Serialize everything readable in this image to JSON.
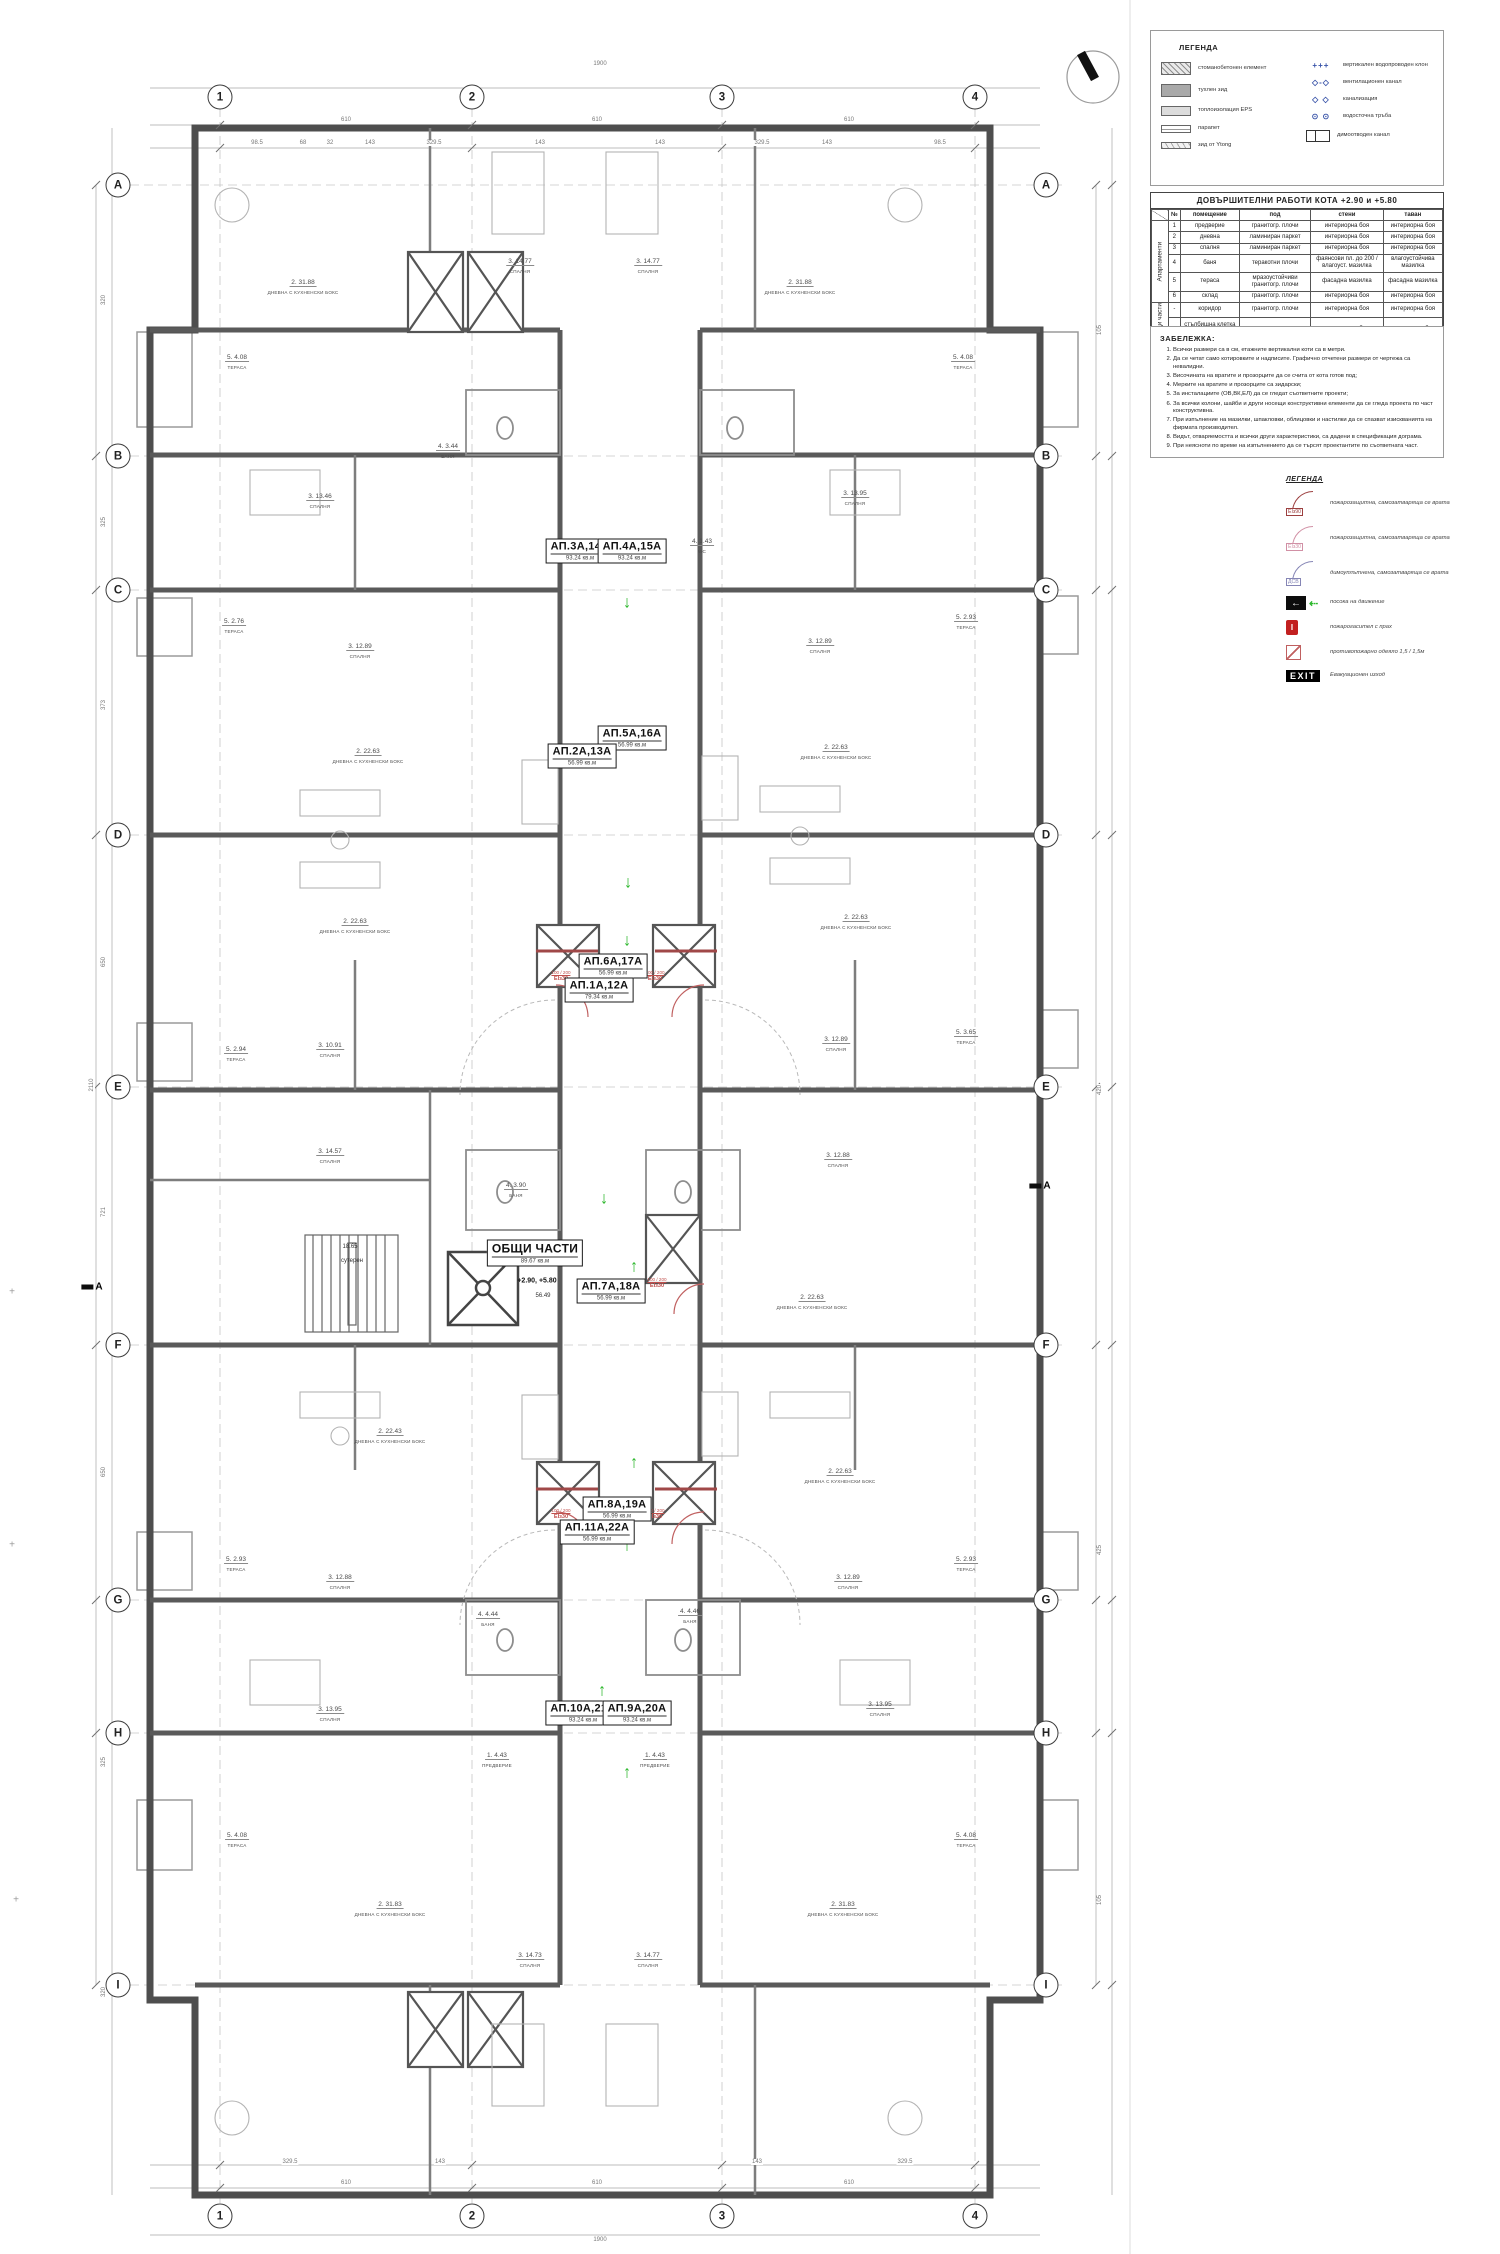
{
  "plan": {
    "grid": {
      "columns": [
        {
          "label": "1",
          "x": 220
        },
        {
          "label": "2",
          "x": 472
        },
        {
          "label": "3",
          "x": 722
        },
        {
          "label": "4",
          "x": 975
        }
      ],
      "top_y": 97,
      "bottom_y": 2216,
      "rows": [
        {
          "label": "A",
          "y": 185
        },
        {
          "label": "B",
          "y": 456
        },
        {
          "label": "C",
          "y": 590
        },
        {
          "label": "D",
          "y": 835
        },
        {
          "label": "E",
          "y": 1087
        },
        {
          "label": "F",
          "y": 1345
        },
        {
          "label": "G",
          "y": 1600
        },
        {
          "label": "H",
          "y": 1733
        },
        {
          "label": "I",
          "y": 1985
        }
      ],
      "left_x": 118,
      "right_x": 1046
    },
    "apartments": [
      {
        "name": "АП.3А,14А",
        "area": "93.24  кв.м",
        "x": 580,
        "y": 551
      },
      {
        "name": "АП.4А,15А",
        "area": "93.24  кв.м",
        "x": 632,
        "y": 551
      },
      {
        "name": "АП.5А,16А",
        "area": "56.99  кв.м",
        "x": 632,
        "y": 738
      },
      {
        "name": "АП.2А,13А",
        "area": "56.99  кв.м",
        "x": 582,
        "y": 756
      },
      {
        "name": "АП.6А,17А",
        "area": "56.99  кв.м",
        "x": 613,
        "y": 966
      },
      {
        "name": "АП.1А,12А",
        "area": "79.34  кв.м",
        "x": 599,
        "y": 990
      },
      {
        "name": "АП.7А,18А",
        "area": "56.99  кв.м",
        "x": 611,
        "y": 1291
      },
      {
        "name": "АП.8А,19А",
        "area": "56.99  кв.м",
        "x": 617,
        "y": 1509
      },
      {
        "name": "АП.11А,22А",
        "area": "56.99  кв.м",
        "x": 597,
        "y": 1532
      },
      {
        "name": "АП.10А,21А",
        "area": "93.24  кв.м",
        "x": 583,
        "y": 1713
      },
      {
        "name": "АП.9А,20А",
        "area": "93.24  кв.м",
        "x": 637,
        "y": 1713
      }
    ],
    "common_area": {
      "name": "ОБЩИ ЧАСТИ",
      "area": "89.67  кв.м",
      "x": 535,
      "y": 1253
    },
    "rooms": [
      {
        "x": 303,
        "y": 283,
        "a": "2. 31.88",
        "n": "ДНЕВНА С КУХНЕНСКИ БОКС"
      },
      {
        "x": 800,
        "y": 283,
        "a": "2. 31.88",
        "n": "ДНЕВНА С КУХНЕНСКИ БОКС"
      },
      {
        "x": 520,
        "y": 262,
        "a": "3. 14.77",
        "n": "СПАЛНЯ"
      },
      {
        "x": 648,
        "y": 262,
        "a": "3. 14.77",
        "n": "СПАЛНЯ"
      },
      {
        "x": 237,
        "y": 358,
        "a": "5. 4.08",
        "n": "ТЕРАСА"
      },
      {
        "x": 963,
        "y": 358,
        "a": "5. 4.08",
        "n": "ТЕРАСА"
      },
      {
        "x": 448,
        "y": 447,
        "a": "4. 3.44",
        "n": "БАНЯ"
      },
      {
        "x": 320,
        "y": 497,
        "a": "3. 13.46",
        "n": "СПАЛНЯ"
      },
      {
        "x": 855,
        "y": 494,
        "a": "3. 13.95",
        "n": "СПАЛНЯ"
      },
      {
        "x": 702,
        "y": 542,
        "a": "4. 1.43",
        "n": "WC"
      },
      {
        "x": 360,
        "y": 647,
        "a": "3. 12.89",
        "n": "СПАЛНЯ"
      },
      {
        "x": 820,
        "y": 642,
        "a": "3. 12.89",
        "n": "СПАЛНЯ"
      },
      {
        "x": 234,
        "y": 622,
        "a": "5. 2.76",
        "n": "ТЕРАСА"
      },
      {
        "x": 966,
        "y": 618,
        "a": "5. 2.93",
        "n": "ТЕРАСА"
      },
      {
        "x": 368,
        "y": 752,
        "a": "2. 22.63",
        "n": "ДНЕВНА С КУХНЕНСКИ БОКС"
      },
      {
        "x": 836,
        "y": 748,
        "a": "2. 22.63",
        "n": "ДНЕВНА С КУХНЕНСКИ БОКС"
      },
      {
        "x": 355,
        "y": 922,
        "a": "2. 22.63",
        "n": "ДНЕВНА С КУХНЕНСКИ БОКС"
      },
      {
        "x": 856,
        "y": 918,
        "a": "2. 22.63",
        "n": "ДНЕВНА С КУХНЕНСКИ БОКС"
      },
      {
        "x": 330,
        "y": 1046,
        "a": "3. 10.91",
        "n": "СПАЛНЯ"
      },
      {
        "x": 836,
        "y": 1040,
        "a": "3. 12.89",
        "n": "СПАЛНЯ"
      },
      {
        "x": 236,
        "y": 1050,
        "a": "5. 2.94",
        "n": "ТЕРАСА"
      },
      {
        "x": 966,
        "y": 1033,
        "a": "5. 3.65",
        "n": "ТЕРАСА"
      },
      {
        "x": 330,
        "y": 1152,
        "a": "3. 14.57",
        "n": "СПАЛНЯ"
      },
      {
        "x": 838,
        "y": 1156,
        "a": "3. 12.88",
        "n": "СПАЛНЯ"
      },
      {
        "x": 516,
        "y": 1186,
        "a": "4. 3.90",
        "n": "БАНЯ"
      },
      {
        "x": 812,
        "y": 1298,
        "a": "2. 22.63",
        "n": "ДНЕВНА С КУХНЕНСКИ БОКС"
      },
      {
        "x": 390,
        "y": 1432,
        "a": "2. 22.43",
        "n": "ДНЕВНА С КУХНЕНСКИ БОКС"
      },
      {
        "x": 840,
        "y": 1472,
        "a": "2. 22.63",
        "n": "ДНЕВНА С КУХНЕНСКИ БОКС"
      },
      {
        "x": 340,
        "y": 1578,
        "a": "3. 12.88",
        "n": "СПАЛНЯ"
      },
      {
        "x": 848,
        "y": 1578,
        "a": "3. 12.89",
        "n": "СПАЛНЯ"
      },
      {
        "x": 236,
        "y": 1560,
        "a": "5. 2.93",
        "n": "ТЕРАСА"
      },
      {
        "x": 966,
        "y": 1560,
        "a": "5. 2.93",
        "n": "ТЕРАСА"
      },
      {
        "x": 488,
        "y": 1615,
        "a": "4. 4.44",
        "n": "БАНЯ"
      },
      {
        "x": 690,
        "y": 1612,
        "a": "4. 4.46",
        "n": "БАНЯ"
      },
      {
        "x": 330,
        "y": 1710,
        "a": "3. 13.95",
        "n": "СПАЛНЯ"
      },
      {
        "x": 880,
        "y": 1705,
        "a": "3. 13.95",
        "n": "СПАЛНЯ"
      },
      {
        "x": 497,
        "y": 1756,
        "a": "1. 4.43",
        "n": "ПРЕДВЕРИЕ"
      },
      {
        "x": 655,
        "y": 1756,
        "a": "1. 4.43",
        "n": "ПРЕДВЕРИЕ"
      },
      {
        "x": 237,
        "y": 1836,
        "a": "5. 4.08",
        "n": "ТЕРАСА"
      },
      {
        "x": 966,
        "y": 1836,
        "a": "5. 4.08",
        "n": "ТЕРАСА"
      },
      {
        "x": 390,
        "y": 1905,
        "a": "2. 31.83",
        "n": "ДНЕВНА С КУХНЕНСКИ БОКС"
      },
      {
        "x": 843,
        "y": 1905,
        "a": "2. 31.83",
        "n": "ДНЕВНА С КУХНЕНСКИ БОКС"
      },
      {
        "x": 530,
        "y": 1956,
        "a": "3. 14.73",
        "n": "СПАЛНЯ"
      },
      {
        "x": 648,
        "y": 1956,
        "a": "3. 14.77",
        "n": "СПАЛНЯ"
      }
    ],
    "extras": [
      {
        "x": 537,
        "y": 1281,
        "t": "+2.90, +5.80",
        "b": true
      },
      {
        "x": 543,
        "y": 1296,
        "t": "56.49"
      },
      {
        "x": 350,
        "y": 1247,
        "t": "18.65"
      },
      {
        "x": 352,
        "y": 1261,
        "t": "сутерен"
      }
    ],
    "door_labels": {
      "dim": "100 / 200",
      "tag": "EIз30",
      "positions": [
        {
          "x": 561,
          "y": 976
        },
        {
          "x": 655,
          "y": 976
        },
        {
          "x": 657,
          "y": 1283
        },
        {
          "x": 561,
          "y": 1514
        },
        {
          "x": 655,
          "y": 1514
        }
      ]
    },
    "arrows": [
      {
        "x": 627,
        "y": 602,
        "d": "down"
      },
      {
        "x": 627,
        "y": 737,
        "d": "down"
      },
      {
        "x": 628,
        "y": 882,
        "d": "down"
      },
      {
        "x": 627,
        "y": 940,
        "d": "down"
      },
      {
        "x": 604,
        "y": 1198,
        "d": "down"
      },
      {
        "x": 573,
        "y": 1257,
        "d": "left"
      },
      {
        "x": 634,
        "y": 1266,
        "d": "up"
      },
      {
        "x": 634,
        "y": 1462,
        "d": "up"
      },
      {
        "x": 627,
        "y": 1545,
        "d": "up"
      },
      {
        "x": 602,
        "y": 1690,
        "d": "up"
      },
      {
        "x": 627,
        "y": 1772,
        "d": "up"
      }
    ],
    "dims": {
      "top": [
        {
          "x": 600,
          "y": 64,
          "t": "1900"
        },
        {
          "x": 346,
          "y": 120,
          "t": "610"
        },
        {
          "x": 597,
          "y": 120,
          "t": "610"
        },
        {
          "x": 849,
          "y": 120,
          "t": "610"
        },
        {
          "x": 257,
          "y": 143,
          "t": "98.5"
        },
        {
          "x": 303,
          "y": 143,
          "t": "68"
        },
        {
          "x": 330,
          "y": 143,
          "t": "32"
        },
        {
          "x": 370,
          "y": 143,
          "t": "143"
        },
        {
          "x": 434,
          "y": 143,
          "t": "329.5"
        },
        {
          "x": 540,
          "y": 143,
          "t": "143"
        },
        {
          "x": 660,
          "y": 143,
          "t": "143"
        },
        {
          "x": 762,
          "y": 143,
          "t": "329.5"
        },
        {
          "x": 827,
          "y": 143,
          "t": "143"
        },
        {
          "x": 940,
          "y": 143,
          "t": "98.5"
        }
      ],
      "bottom": [
        {
          "x": 600,
          "y": 2240,
          "t": "1900"
        },
        {
          "x": 346,
          "y": 2183,
          "t": "610"
        },
        {
          "x": 597,
          "y": 2183,
          "t": "610"
        },
        {
          "x": 849,
          "y": 2183,
          "t": "610"
        },
        {
          "x": 290,
          "y": 2162,
          "t": "329.5"
        },
        {
          "x": 905,
          "y": 2162,
          "t": "329.5"
        },
        {
          "x": 440,
          "y": 2162,
          "t": "143"
        },
        {
          "x": 757,
          "y": 2162,
          "t": "143"
        }
      ],
      "left": [
        {
          "x": 104,
          "y": 300,
          "t": "320"
        },
        {
          "x": 104,
          "y": 522,
          "t": "325"
        },
        {
          "x": 104,
          "y": 705,
          "t": "373"
        },
        {
          "x": 104,
          "y": 962,
          "t": "650"
        },
        {
          "x": 104,
          "y": 1212,
          "t": "721"
        },
        {
          "x": 104,
          "y": 1472,
          "t": "650"
        },
        {
          "x": 104,
          "y": 1762,
          "t": "325"
        },
        {
          "x": 104,
          "y": 1992,
          "t": "320"
        },
        {
          "x": 92,
          "y": 1085,
          "t": "2110"
        }
      ],
      "right": [
        {
          "x": 1100,
          "y": 330,
          "t": "105"
        },
        {
          "x": 1100,
          "y": 1090,
          "t": "420"
        },
        {
          "x": 1100,
          "y": 1550,
          "t": "425"
        },
        {
          "x": 1100,
          "y": 1900,
          "t": "105"
        }
      ]
    },
    "section": {
      "label": "А",
      "markers": [
        {
          "x": 92,
          "y": 1287
        },
        {
          "x": 1040,
          "y": 1186
        }
      ]
    },
    "cross_marks": [
      {
        "x": 12,
        "y": 1292,
        "t": "+"
      },
      {
        "x": 12,
        "y": 1545,
        "t": "+"
      },
      {
        "x": 16,
        "y": 1900,
        "t": "+"
      }
    ]
  },
  "legend1": {
    "title": "ЛЕГЕНДА",
    "left_items": [
      {
        "icon": "concrete-swatch",
        "label": "стоманобетонен елемент"
      },
      {
        "icon": "brick-swatch",
        "label": "тухлен зид"
      },
      {
        "icon": "eps-swatch",
        "label": "топлоизолация EPS"
      },
      {
        "icon": "parapet-swatch",
        "label": "парапет"
      },
      {
        "icon": "ytong-swatch",
        "label": "зид от Ytong"
      }
    ],
    "right_items": [
      {
        "icon": "water-riser",
        "glyph": "+++",
        "label": "вертикален водопроводен клон"
      },
      {
        "icon": "vent-duct",
        "glyph": "◇-◇",
        "label": "вентилационен канал"
      },
      {
        "icon": "sewer",
        "glyph": "◇ ◇",
        "label": "канализация"
      },
      {
        "icon": "downpipe",
        "glyph": "⊙ ⊙",
        "label": "водосточна тръба"
      },
      {
        "icon": "smoke-duct",
        "glyph": "",
        "label": "димоотводен канал"
      }
    ]
  },
  "finish_table": {
    "title": "ДОВЪРШИТЕЛНИ РАБОТИ КОТА +2.90 и +5.80",
    "columns": [
      "№",
      "помещение",
      "под",
      "стени",
      "таван"
    ],
    "groups": [
      {
        "name": "Апартаменти",
        "rows": [
          [
            "1",
            "предверие",
            "гранитогр. плочи",
            "интериорна боя",
            "интериорна боя"
          ],
          [
            "2",
            "дневна",
            "ламиниран паркет",
            "интериорна боя",
            "интериорна боя"
          ],
          [
            "3",
            "спалня",
            "ламиниран паркет",
            "интериорна боя",
            "интериорна боя"
          ],
          [
            "4",
            "баня",
            "теракотни плочи",
            "фаянсови пл. до 200 / влагоуст. мазилка",
            "влагоустойчива мазилка"
          ],
          [
            "5",
            "тераса",
            "мразоустойчиви гранитогр. плочи",
            "фасадна мазилка",
            "фасадна мазилка"
          ],
          [
            "6",
            "склад",
            "гранитогр. плочи",
            "интериорна боя",
            "интериорна боя"
          ]
        ]
      },
      {
        "name": "Общи части",
        "rows": [
          [
            "-",
            "коридор",
            "гранитогр. плочи",
            "интериорна боя",
            "интериорна боя"
          ],
          [
            "-",
            "стълбищна клетка с коридор",
            "гранитогр. плочи",
            "интериорна боя",
            "интериорна боя"
          ]
        ]
      }
    ]
  },
  "notes": {
    "title": "ЗАБЕЛЕЖКА:",
    "items": [
      "Всички размери са в см, етажните вертикални коти са в метри.",
      "Да се четат само котировките и надписите. Графично отчетени размери от чертежа са невалидни.",
      "Височината на вратите и прозорците да се счита от кота готов под;",
      "Мерките на вратите и прозорците са зидарски;",
      "За инсталациите (ОВ,ВК,ЕЛ) да се гледат съответните проекти;",
      "За всички колони, шайби и други носещи конструктивни елементи да се гледа проекта по част конструктивна.",
      "При изпълнение на мазилки, шпакловки, облицовки и настилки да се спазват изискванията на фирмата производител.",
      "Видът, отваряемостта и всички други характеристики, са дадени в спецификация дограма.",
      "При неясноти по време на изпълнението да се търсят проектантите по съответната част."
    ]
  },
  "legend2": {
    "title": "ЛЕГЕНДА",
    "items": [
      {
        "icon": "fire-door-90",
        "tag": "EIз90",
        "label": "пожарозащитна, самозатваряща се врата"
      },
      {
        "icon": "fire-door-30",
        "tag": "EIз30",
        "label": "пожарозащитна, самозатваряща се врата"
      },
      {
        "icon": "smoke-door",
        "tag": "ДСВ",
        "label": "димоуплътнена, самозатваряща се врата"
      },
      {
        "icon": "direction-arrow",
        "glyph": "←",
        "glyph2": "⇠",
        "label": "посока на движение"
      },
      {
        "icon": "fire-extinguisher",
        "glyph": "I",
        "label": "пожарогасител с прах"
      },
      {
        "icon": "fire-blanket",
        "label": "противопожарно одеяло 1,5 / 1,5м"
      },
      {
        "icon": "exit-sign",
        "tag": "EXIT",
        "label": "Евакуационен изход"
      }
    ]
  }
}
